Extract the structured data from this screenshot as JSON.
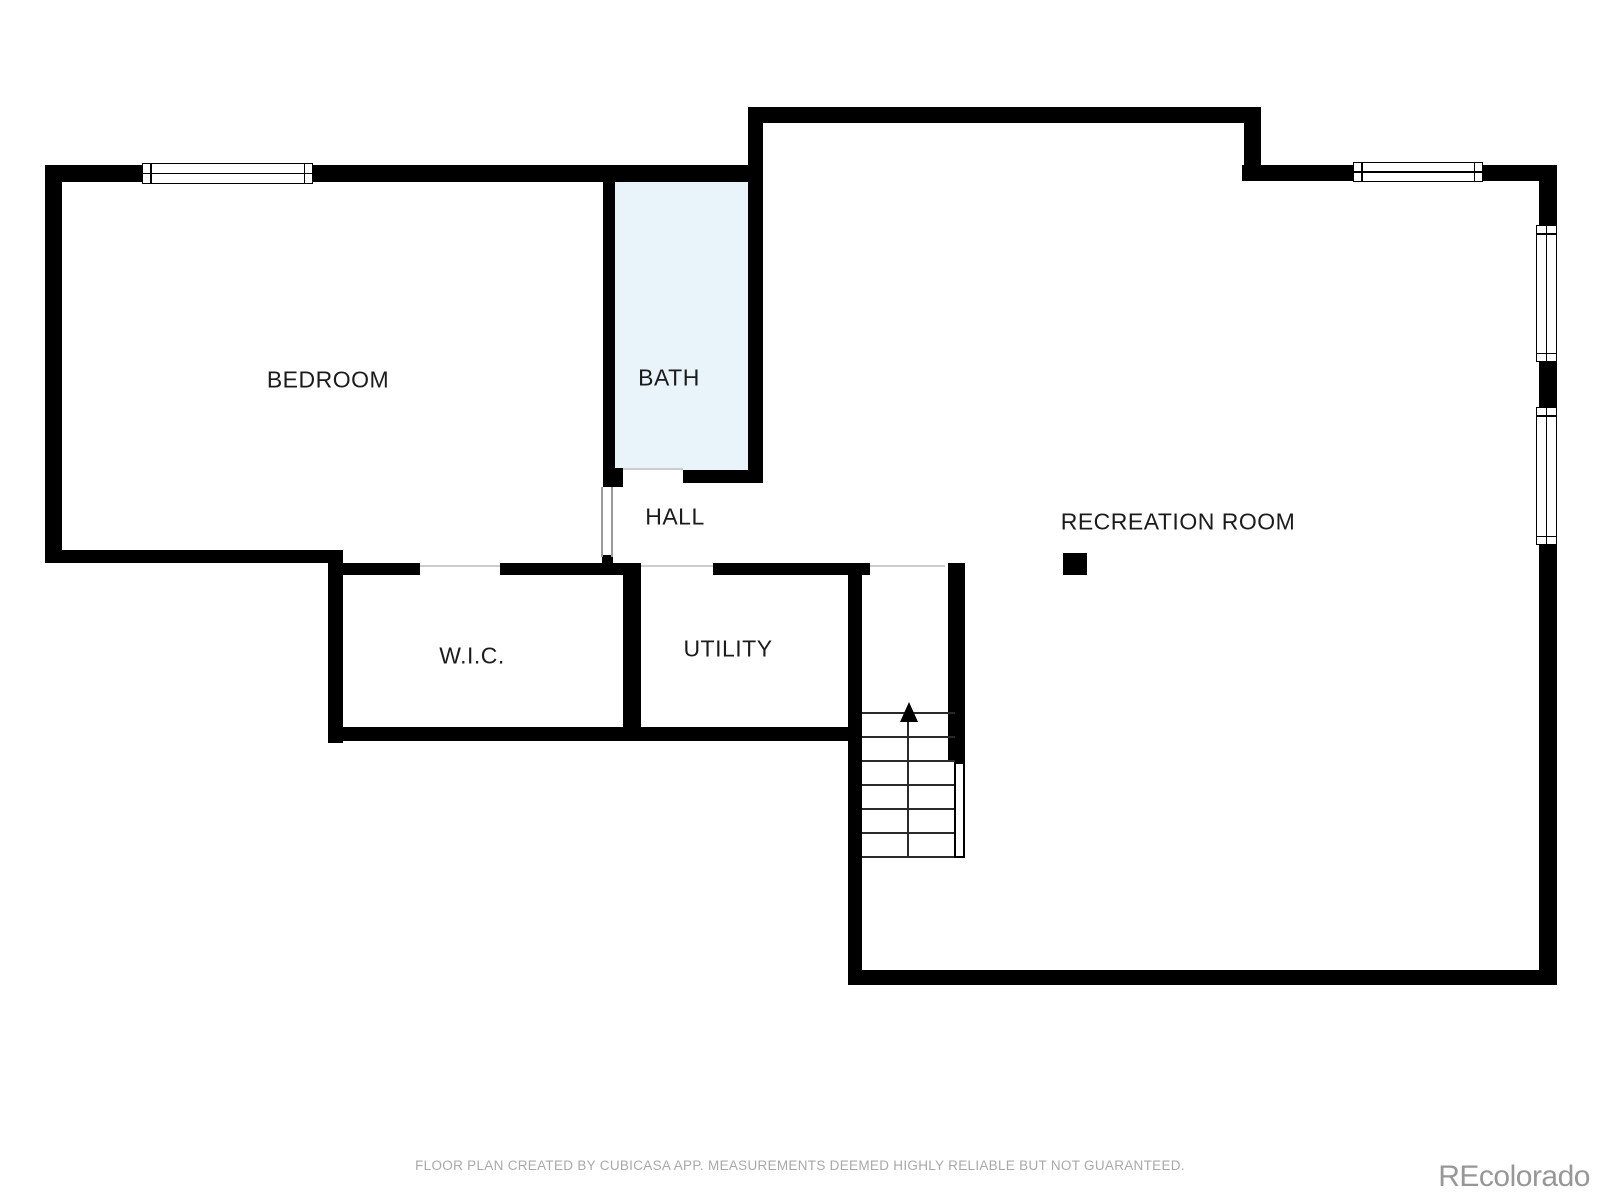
{
  "plan": {
    "title": "Basement floor plan",
    "rooms": [
      {
        "id": "bedroom",
        "label": "BEDROOM"
      },
      {
        "id": "bath",
        "label": "BATH"
      },
      {
        "id": "hall",
        "label": "HALL"
      },
      {
        "id": "wic",
        "label": "W.I.C."
      },
      {
        "id": "utility",
        "label": "UTILITY"
      },
      {
        "id": "recreation",
        "label": "RECREATION ROOM"
      }
    ],
    "stairs": {
      "direction": "up",
      "steps": 6
    },
    "windows": {
      "count": 4
    },
    "colors": {
      "wall": "#000000",
      "bath_fill": "#e9f3fa",
      "label_text": "#1b1b1b",
      "footer_text": "#a9a9a9",
      "watermark_text": "#979797"
    }
  },
  "footer": {
    "disclaimer": "FLOOR PLAN CREATED BY CUBICASA APP. MEASUREMENTS DEEMED HIGHLY RELIABLE BUT NOT GUARANTEED."
  },
  "watermark": {
    "text": "REcolorado"
  }
}
